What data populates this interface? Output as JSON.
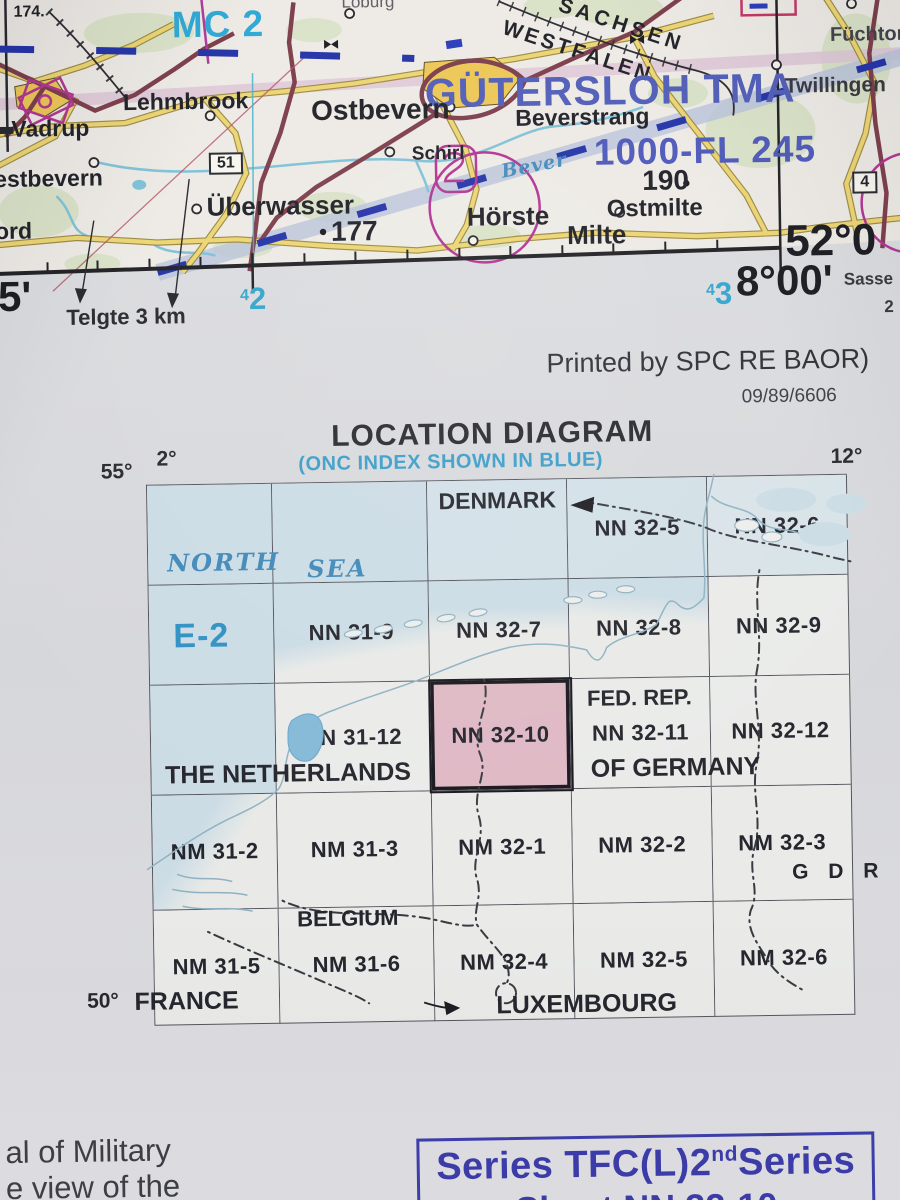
{
  "map": {
    "labels": {
      "spot_174": "174.",
      "mc2": "MC 2",
      "loburg": "Loburg",
      "sachsen": "SACHSEN",
      "westfalen": "WESTFALEN",
      "gutersloh_tma": "GÜTERSLOH TMA",
      "lehmbrook": "Lehmbrook",
      "ostbevern": "Ostbevern",
      "beverstrang": "Beverstrang",
      "fuchtorf": "Füchtorf",
      "twillingen": "Twillingen",
      "schirl": "Schirl",
      "vadrup": "Vadrup",
      "westbevern": "estbevern",
      "ord": "ord",
      "road_51": "51",
      "road_4": "4",
      "route_altitude": "1000-FL 245",
      "spot_190": "190",
      "spot_177": "177",
      "uberwasser": "Überwasser",
      "horste": "Hörste",
      "ostmilte": "Ostmilte",
      "milte": "Milte",
      "bever_river": "Bever"
    },
    "margin": {
      "minutes_left": "5'",
      "telgte": "Telgte 3 km",
      "grid_42_sup": "4",
      "grid_42_num": "2",
      "grid_43_sup": "4",
      "grid_43_num": "3",
      "lon_label": "8°00'",
      "lat_label": "52°0",
      "sasse": "Sasse",
      "edge_two": "2"
    }
  },
  "imprint": {
    "printed_by": "Printed by SPC RE BAOR)",
    "code": "09/89/6606"
  },
  "location_diagram": {
    "title": "LOCATION DIAGRAM",
    "subtitle": "(ONC INDEX SHOWN IN BLUE)",
    "corner": {
      "top_left_lat": "55°",
      "top_left_lon": "2°",
      "top_right_lon": "12°",
      "bottom_left_lat": "50°"
    },
    "sea": {
      "word1": "NORTH",
      "word2": "SEA"
    },
    "onc_sheet": "E-2",
    "highlighted_sheet": "NN 32-10",
    "rows": [
      {
        "cells": [
          "",
          "",
          "",
          "NN 32-5",
          "NN 32-6"
        ]
      },
      {
        "cells": [
          "",
          "NN 31-9",
          "NN 32-7",
          "NN 32-8",
          "NN 32-9"
        ]
      },
      {
        "cells": [
          "",
          "NN 31-12",
          "NN 32-10",
          "NN 32-11",
          "NN 32-12"
        ]
      },
      {
        "cells": [
          "NM 31-2",
          "NM 31-3",
          "NM 32-1",
          "NM 32-2",
          "NM 32-3"
        ]
      },
      {
        "cells": [
          "NM 31-5",
          "NM 31-6",
          "NM 32-4",
          "NM 32-5",
          "NM 32-6"
        ]
      }
    ],
    "countries": {
      "denmark": "DENMARK",
      "fed_rep": "FED. REP.",
      "of_germany": "OF GERMANY",
      "netherlands": "THE NETHERLANDS",
      "gdr": "G D R",
      "belgium": "BELGIUM",
      "france": "FRANCE",
      "luxembourg": "LUXEMBOURG"
    }
  },
  "footer": {
    "left_line1": "al of Military",
    "left_line2": "e view of the",
    "series_prefix": "Series TFC(L)2",
    "series_sup": "nd",
    "series_suffix": "Series",
    "series_line2": "Sheet NN 32-10"
  },
  "colors": {
    "index_blue": "#3a9dc8",
    "onc_blue": "#2f90c4",
    "sea_fill": "#cbdce5",
    "highlight_pink": "#dfb9c5",
    "airspace_blue": "#4d5ab6",
    "grid_cyan": "#2fa3cc",
    "series_blue": "#3b3bac",
    "route_blue": "#1f2fa6",
    "road_maroon": "#7a3947",
    "road_yellow": "#ecd470",
    "magenta": "#b13090"
  }
}
